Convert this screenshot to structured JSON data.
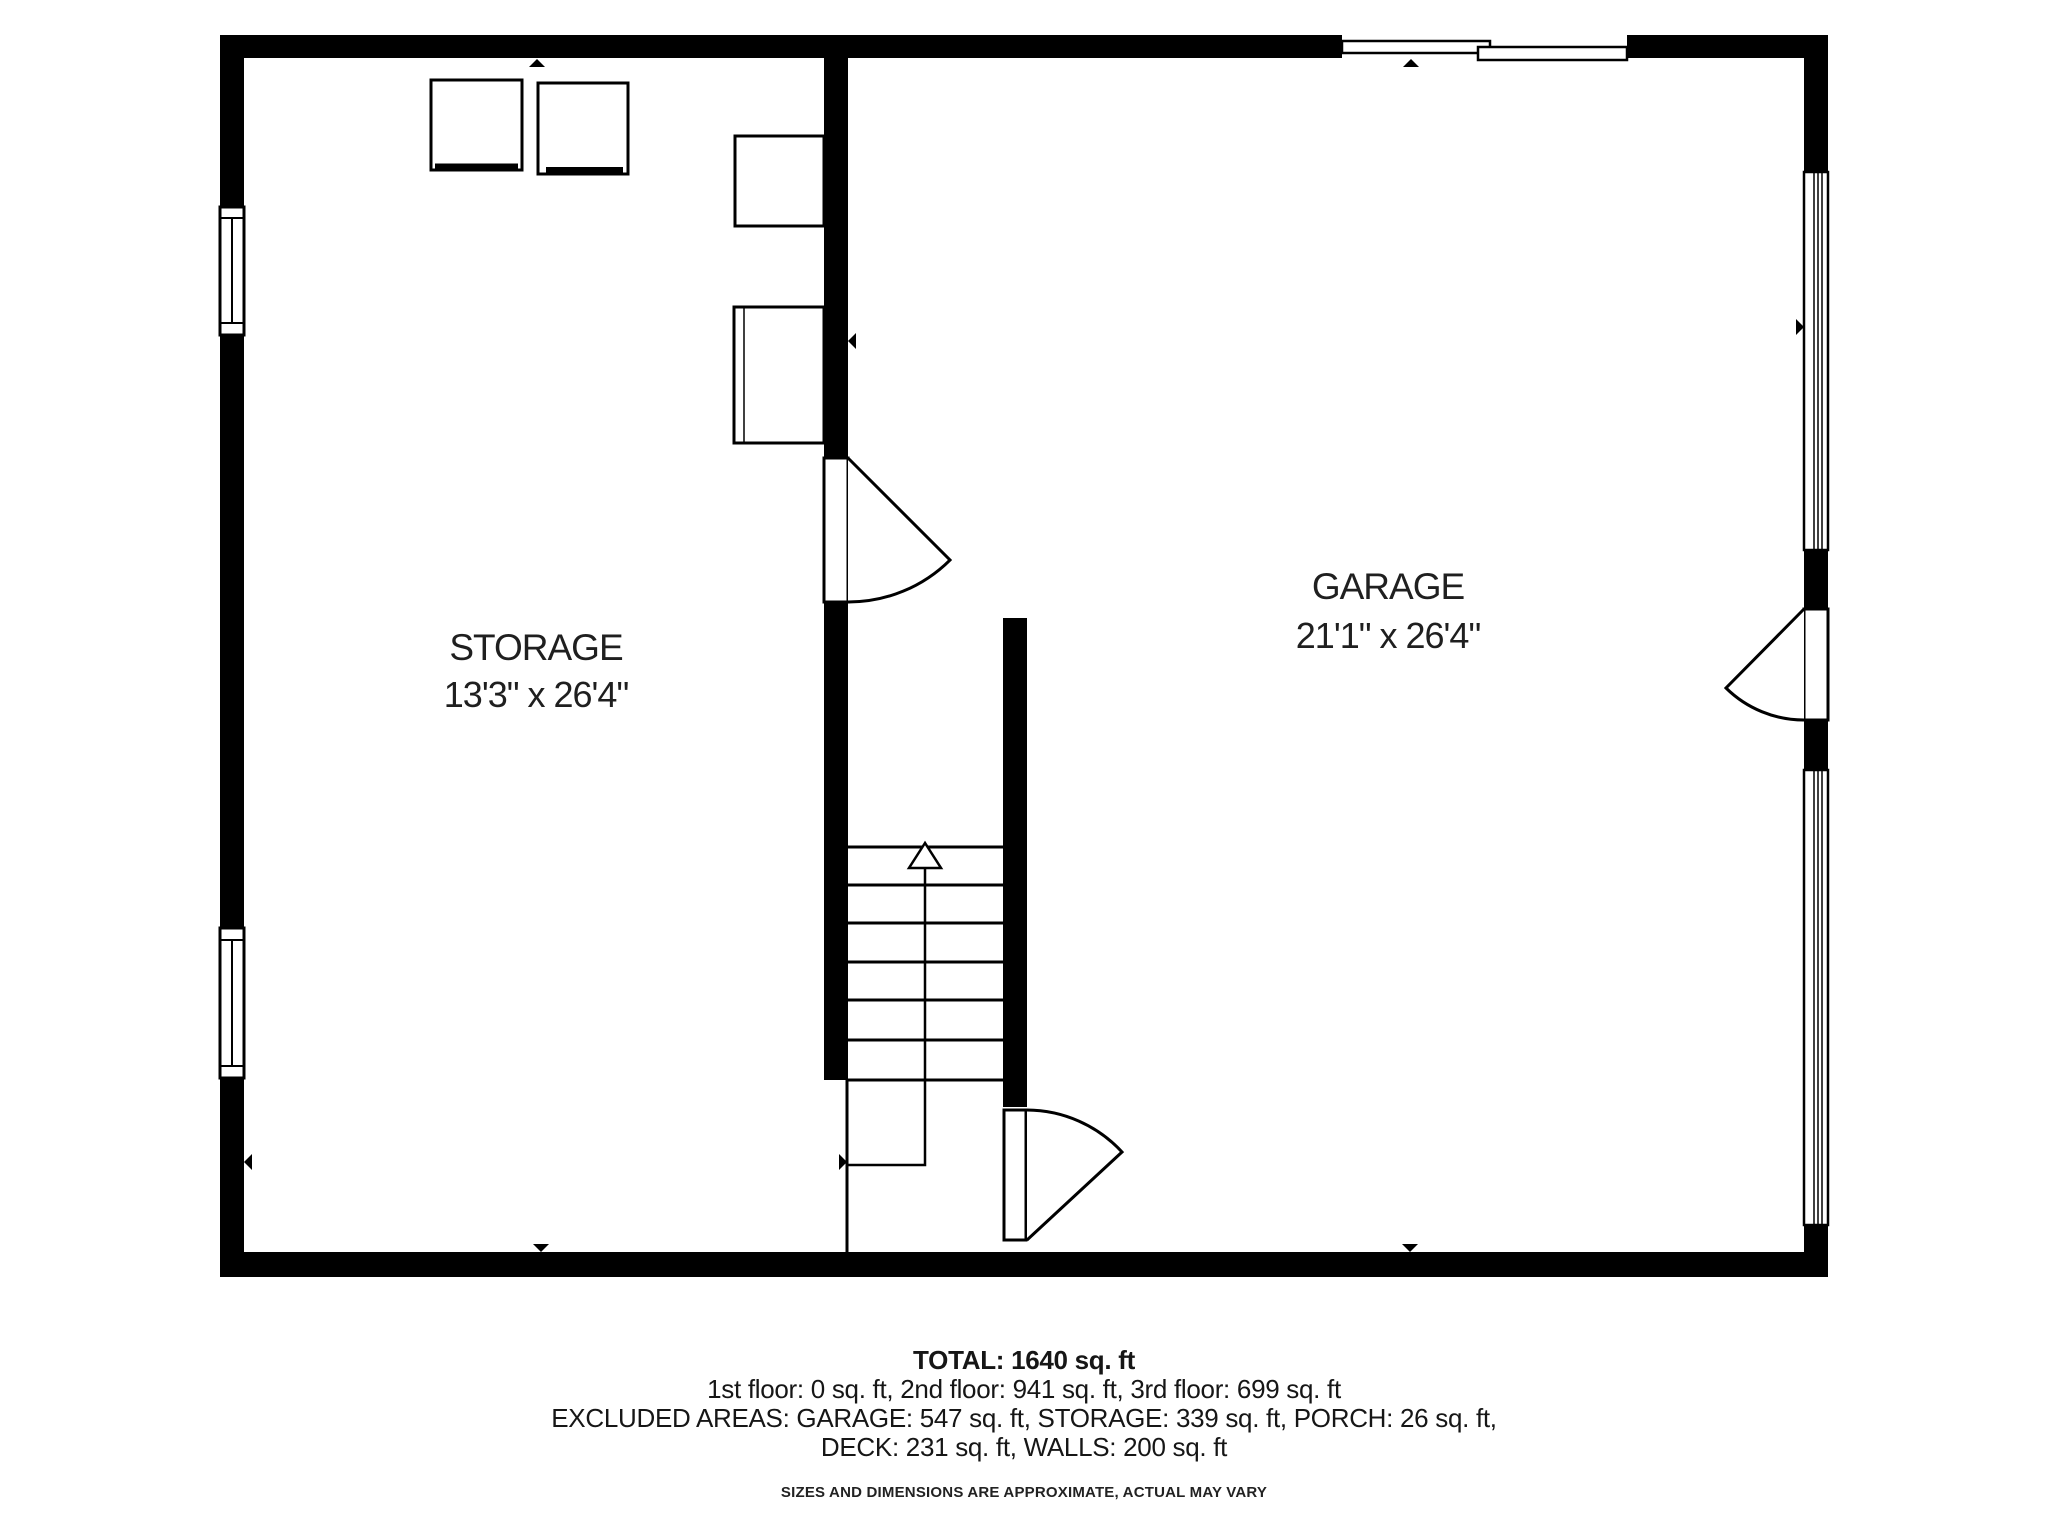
{
  "rooms": {
    "storage": {
      "name": "STORAGE",
      "dimensions": "13'3\" x 26'4\""
    },
    "garage": {
      "name": "GARAGE",
      "dimensions": "21'1\" x 26'4\""
    }
  },
  "summary": {
    "total": "TOTAL: 1640 sq. ft",
    "floors": "1st floor: 0 sq. ft, 2nd floor: 941 sq. ft, 3rd floor: 699 sq. ft",
    "excluded_line1": "EXCLUDED AREAS: GARAGE: 547 sq. ft, STORAGE: 339 sq. ft, PORCH: 26 sq. ft,",
    "excluded_line2": "DECK: 231 sq. ft, WALLS: 200 sq. ft",
    "disclaimer": "SIZES AND DIMENSIONS ARE APPROXIMATE, ACTUAL MAY VARY"
  },
  "colors": {
    "wall": "#000000",
    "background": "#ffffff",
    "text": "#1e1e1e"
  }
}
